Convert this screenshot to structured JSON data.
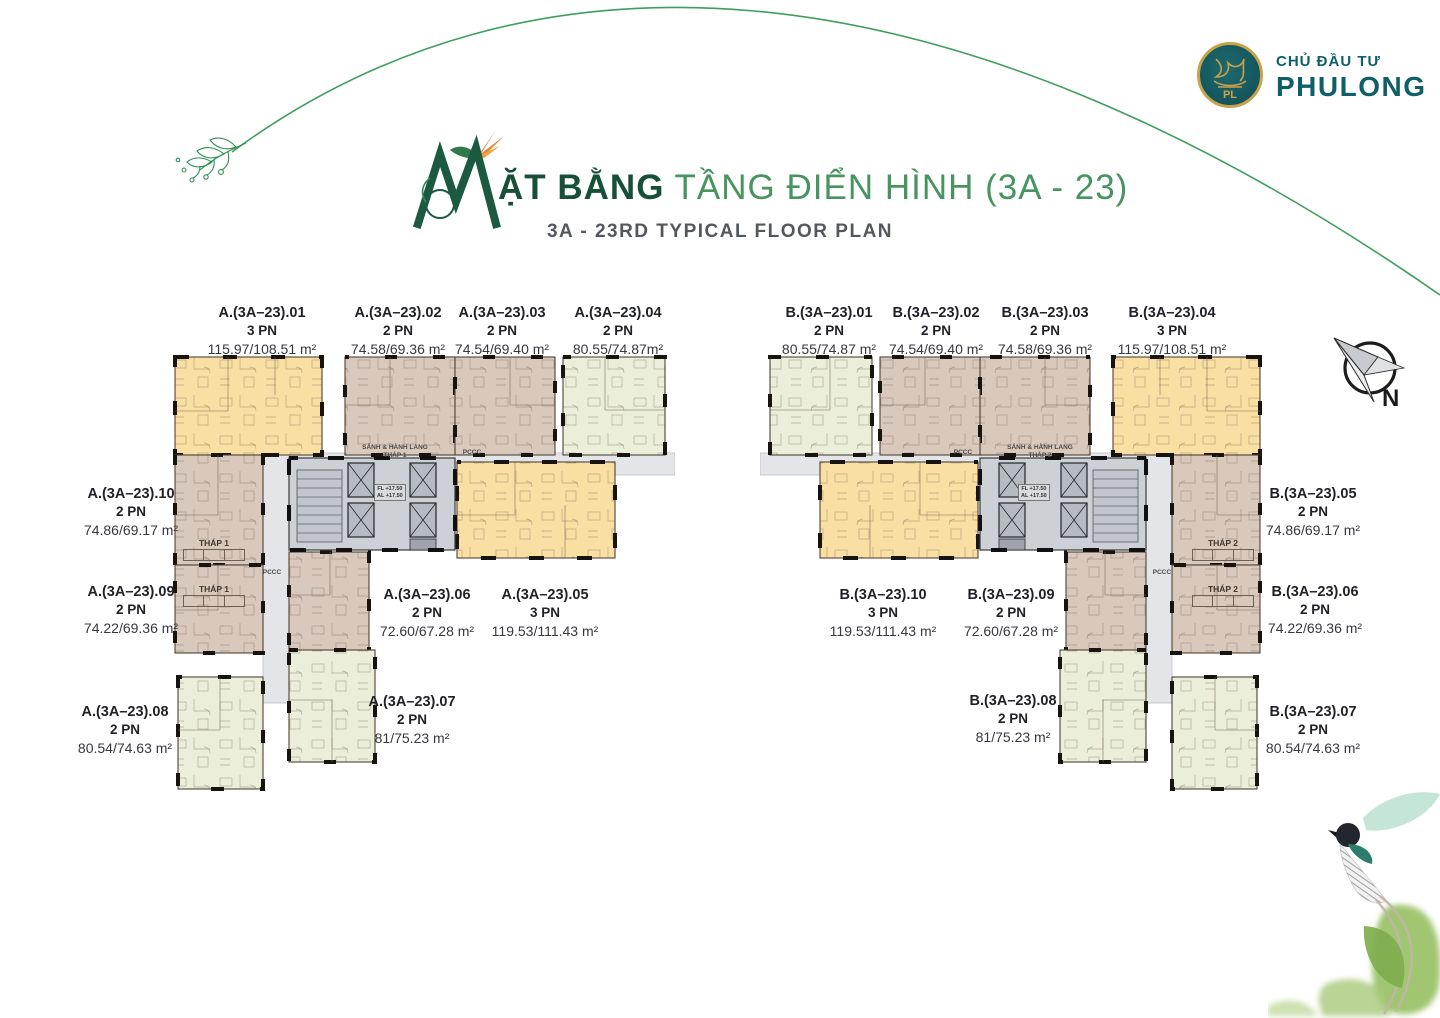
{
  "branding": {
    "developer_label": "CHỦ ĐẦU TƯ",
    "developer_name": "PHULONG",
    "logo_monogram": "PL"
  },
  "title": {
    "decorative_letter": "M",
    "heading_bold": "ẶT BẰNG",
    "heading_regular": " TẦNG ĐIỂN HÌNH (3A - 23)",
    "subtitle": "3A - 23RD TYPICAL FLOOR PLAN"
  },
  "compass": {
    "label": "N"
  },
  "plan": {
    "lobby_label": "SẢNH & HÀNH LANG",
    "tower1_tag": "THÁP 1",
    "tower2_tag": "THÁP 2",
    "pccc": "PCCC",
    "core_note_line1": "FL +17.50",
    "core_note_line2": "AL +17.50"
  },
  "colors": {
    "unit_orange": "#fadfa3",
    "unit_taupe": "#d9c8bc",
    "unit_green": "#ebefd9",
    "corridor_gray": "#e4e5e8",
    "core_gray": "#cdd1d6",
    "brand_teal": "#0f5f68",
    "title_dark_green": "#174f38",
    "title_light_green": "#47945f",
    "arc_green": "#3f9e5d"
  },
  "towerA": {
    "units": [
      {
        "code": "A.(3A–23).01",
        "bedrooms": "3 PN",
        "area": "115.97/108.51 m²"
      },
      {
        "code": "A.(3A–23).02",
        "bedrooms": "2 PN",
        "area": "74.58/69.36 m²"
      },
      {
        "code": "A.(3A–23).03",
        "bedrooms": "2 PN",
        "area": "74.54/69.40 m²"
      },
      {
        "code": "A.(3A–23).04",
        "bedrooms": "2 PN",
        "area": "80.55/74.87m²"
      },
      {
        "code": "A.(3A–23).05",
        "bedrooms": "3 PN",
        "area": "119.53/111.43 m²"
      },
      {
        "code": "A.(3A–23).06",
        "bedrooms": "2 PN",
        "area": "72.60/67.28 m²"
      },
      {
        "code": "A.(3A–23).07",
        "bedrooms": "2 PN",
        "area": "81/75.23 m²"
      },
      {
        "code": "A.(3A–23).08",
        "bedrooms": "2 PN",
        "area": "80.54/74.63 m²"
      },
      {
        "code": "A.(3A–23).09",
        "bedrooms": "2 PN",
        "area": "74.22/69.36 m²"
      },
      {
        "code": "A.(3A–23).10",
        "bedrooms": "2 PN",
        "area": "74.86/69.17 m²"
      }
    ]
  },
  "towerB": {
    "units": [
      {
        "code": "B.(3A–23).01",
        "bedrooms": "2 PN",
        "area": "80.55/74.87 m²"
      },
      {
        "code": "B.(3A–23).02",
        "bedrooms": "2 PN",
        "area": "74.54/69.40 m²"
      },
      {
        "code": "B.(3A–23).03",
        "bedrooms": "2 PN",
        "area": "74.58/69.36 m²"
      },
      {
        "code": "B.(3A–23).04",
        "bedrooms": "3 PN",
        "area": "115.97/108.51 m²"
      },
      {
        "code": "B.(3A–23).05",
        "bedrooms": "2 PN",
        "area": "74.86/69.17 m²"
      },
      {
        "code": "B.(3A–23).06",
        "bedrooms": "2 PN",
        "area": "74.22/69.36 m²"
      },
      {
        "code": "B.(3A–23).07",
        "bedrooms": "2 PN",
        "area": "80.54/74.63 m²"
      },
      {
        "code": "B.(3A–23).08",
        "bedrooms": "2 PN",
        "area": "81/75.23 m²"
      },
      {
        "code": "B.(3A–23).09",
        "bedrooms": "2 PN",
        "area": "72.60/67.28 m²"
      },
      {
        "code": "B.(3A–23).10",
        "bedrooms": "3 PN",
        "area": "119.53/111.43 m²"
      }
    ]
  }
}
